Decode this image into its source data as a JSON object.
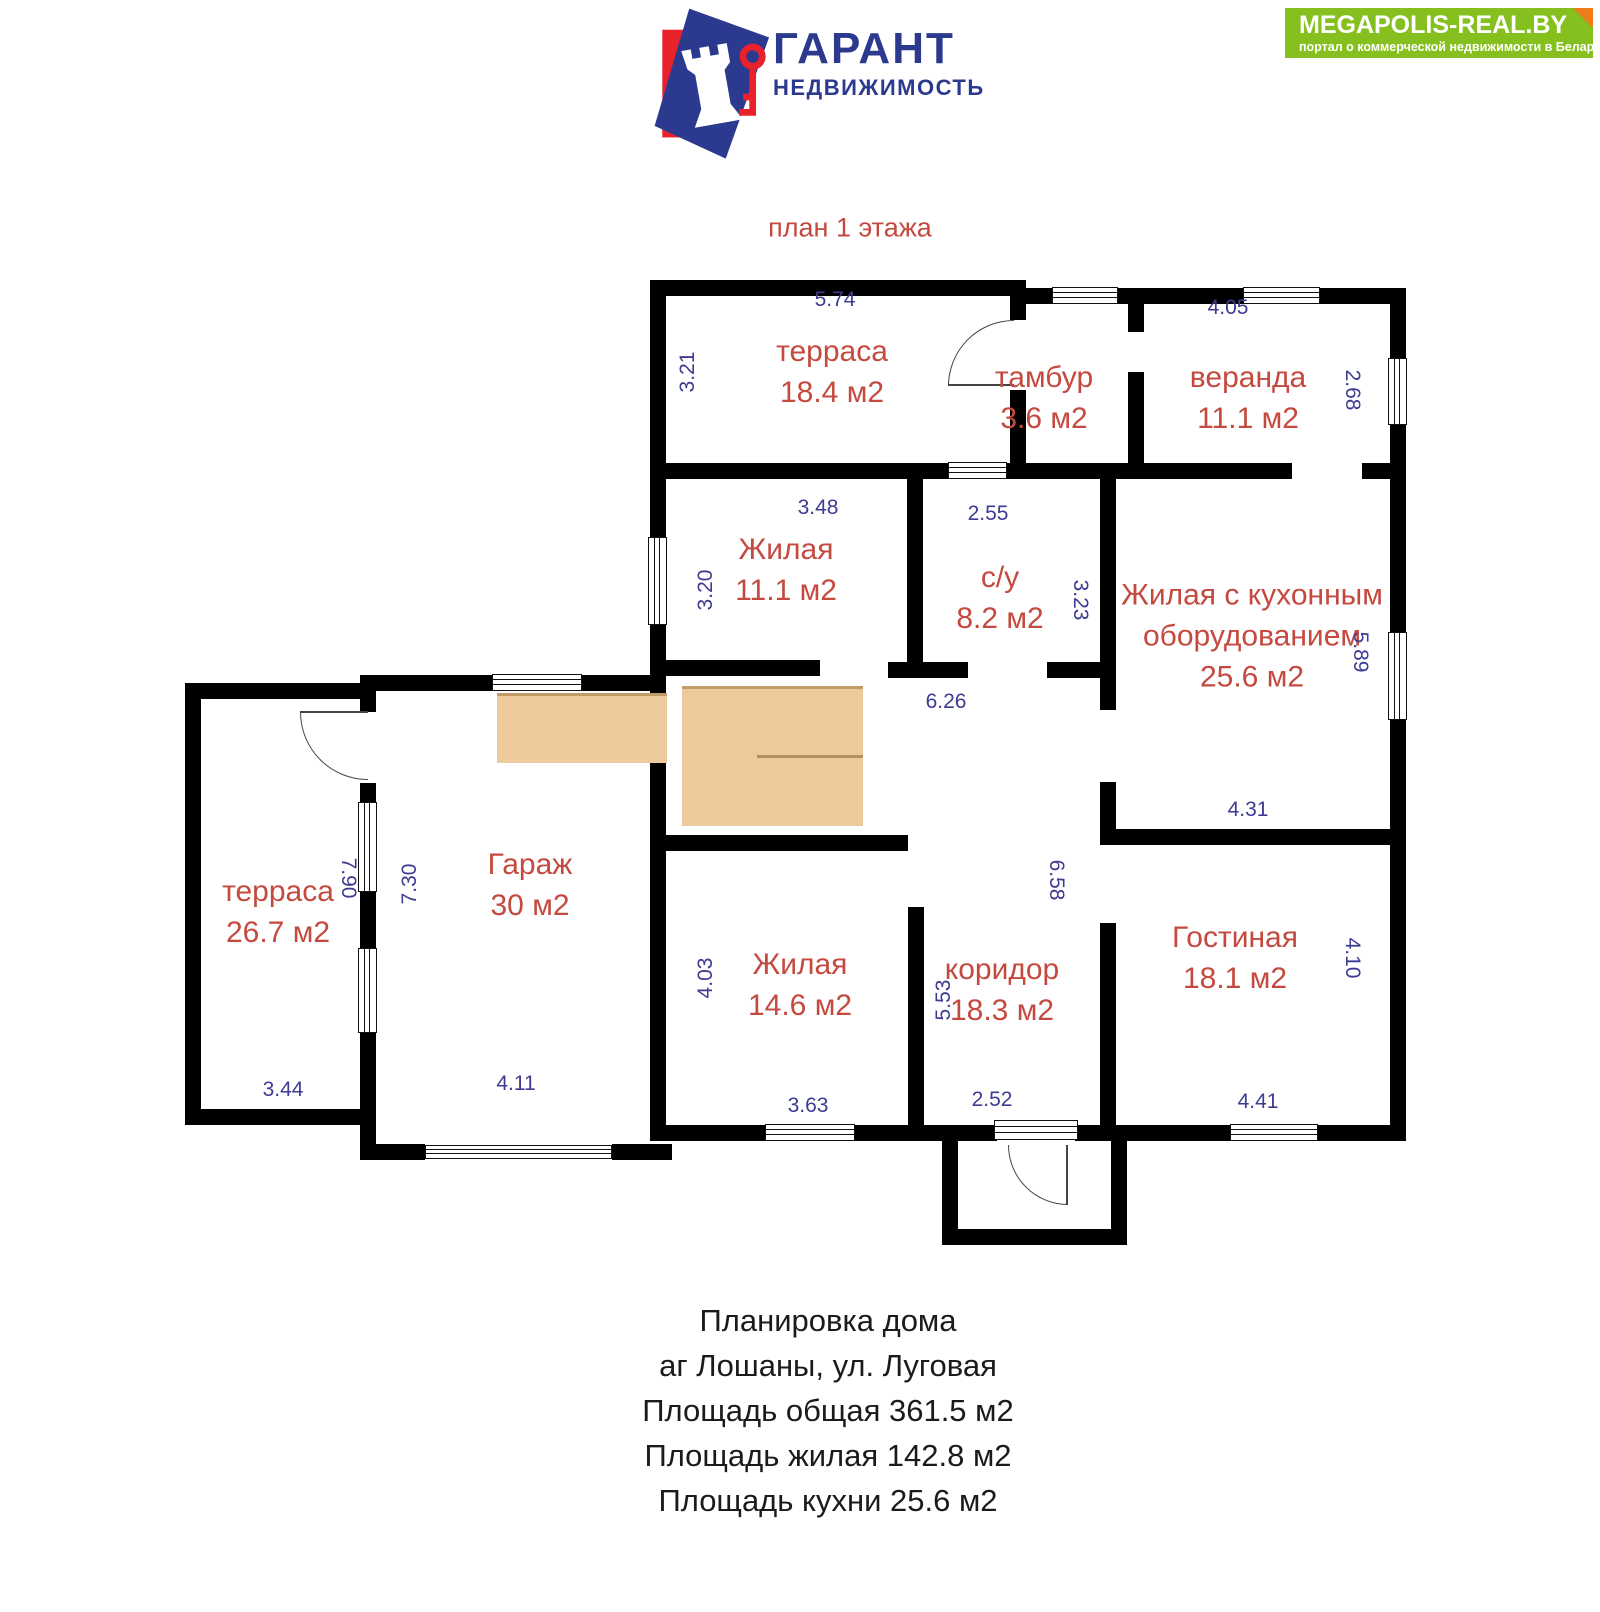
{
  "header": {
    "logo": {
      "title": "ГАРАНТ",
      "subtitle": "НЕДВИЖИМОСТЬ"
    },
    "banner": {
      "title": "MEGAPOLIS-REAL.BY",
      "subtitle": "портал о коммерческой недвижимости в Беларуси"
    }
  },
  "plan": {
    "title": "план 1 этажа",
    "rooms": [
      {
        "name": "терраса",
        "area": "18.4 м2"
      },
      {
        "name": "тамбур",
        "area": "3.6 м2"
      },
      {
        "name": "веранда",
        "area": "11.1 м2"
      },
      {
        "name": "Жилая",
        "area": "11.1 м2"
      },
      {
        "name": "с/у",
        "area": "8.2 м2"
      },
      {
        "name": "Жилая с кухонным оборудованием",
        "area": "25.6 м2"
      },
      {
        "name": "Гараж",
        "area": "30 м2"
      },
      {
        "name": "терраса",
        "area": "26.7 м2"
      },
      {
        "name": "Жилая",
        "area": "14.6 м2"
      },
      {
        "name": "коридор",
        "area": "18.3 м2"
      },
      {
        "name": "Гостиная",
        "area": "18.1 м2"
      }
    ],
    "dims": [
      "5.74",
      "3.21",
      "4.05",
      "2.68",
      "3.48",
      "2.55",
      "3.20",
      "3.23",
      "5.89",
      "6.26",
      "7.90",
      "7.30",
      "4.31",
      "6.58",
      "4.03",
      "5.53",
      "4.10",
      "3.63",
      "2.52",
      "4.41",
      "3.44",
      "4.11"
    ]
  },
  "footer": {
    "lines": [
      "Планировка дома",
      "аг Лошаны, ул. Луговая",
      "Площадь общая 361.5 м2",
      "Площадь жилая 142.8 м2",
      "Площадь кухни 25.6 м2"
    ]
  },
  "colors": {
    "room_label": "#c4493e",
    "dimension": "#3e3b92",
    "wall": "#000000",
    "stairs": "#ecca9b",
    "banner_green": "#85c01f",
    "banner_fold": "#ef7b1a",
    "logo_navy": "#2b3a8f",
    "logo_red": "#e8212b"
  }
}
